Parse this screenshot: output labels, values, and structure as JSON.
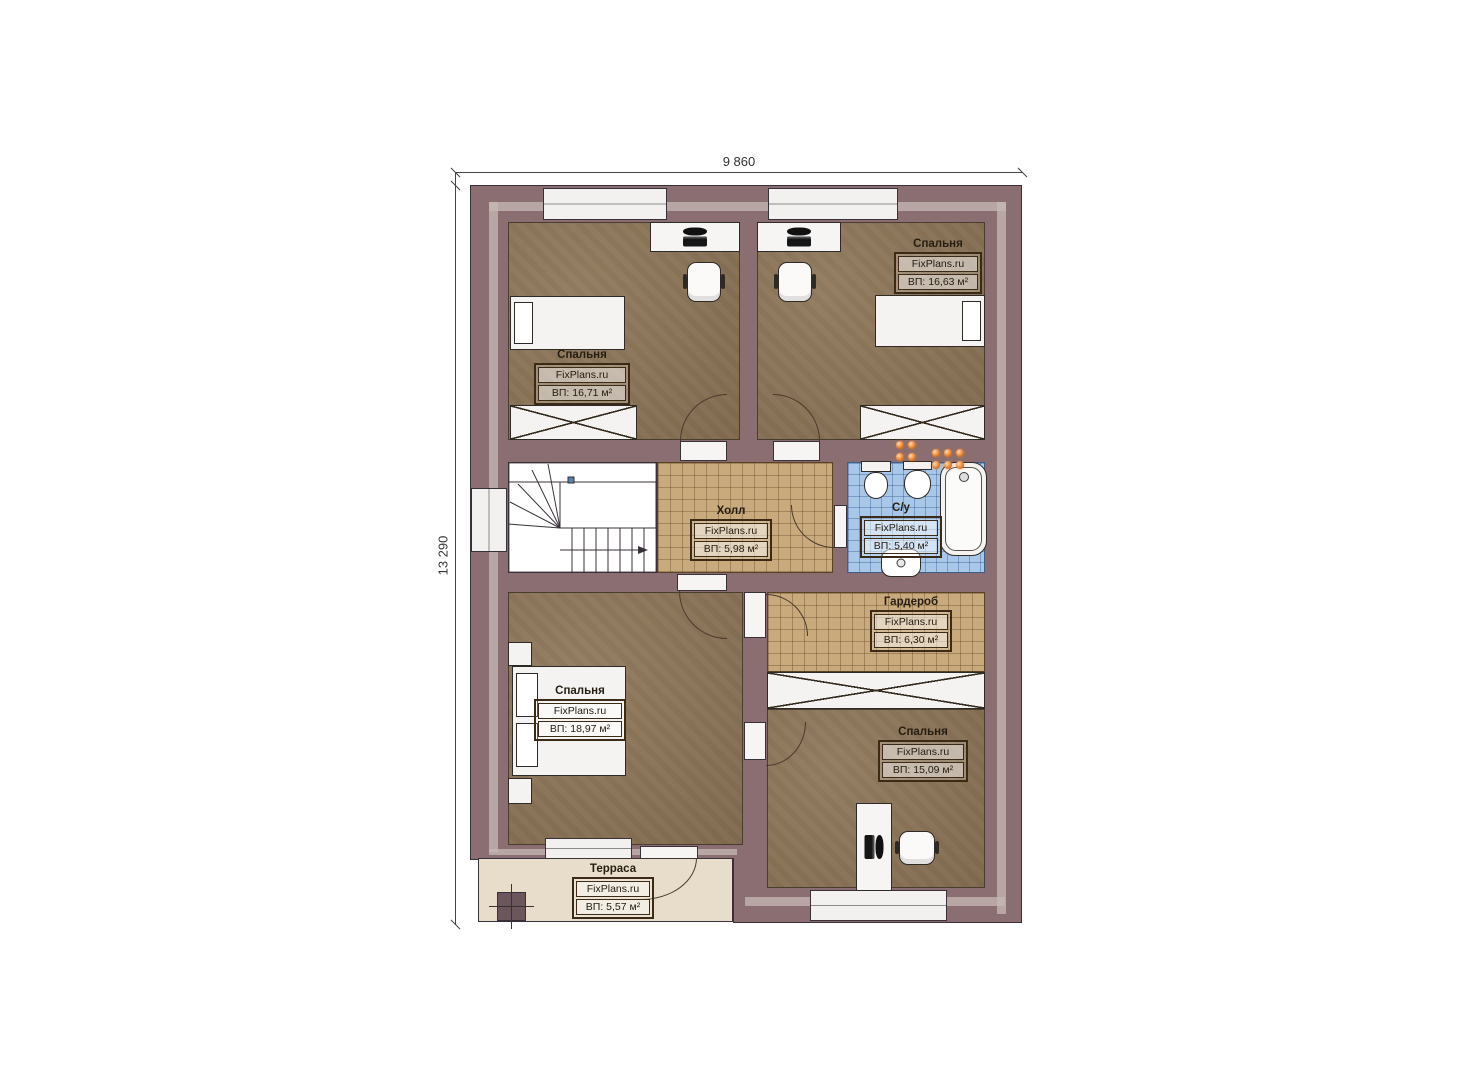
{
  "dimensions": {
    "width": "9 860",
    "height": "13 290"
  },
  "rooms": [
    {
      "name": "Спальня",
      "brand": "FixPlans.ru",
      "area": "ВП: 16,71 м²"
    },
    {
      "name": "Спальня",
      "brand": "FixPlans.ru",
      "area": "ВП: 16,63 м²"
    },
    {
      "name": "Холл",
      "brand": "FixPlans.ru",
      "area": "ВП: 5,98 м²"
    },
    {
      "name": "С/у",
      "brand": "FixPlans.ru",
      "area": "ВП: 5,40 м²"
    },
    {
      "name": "Гардероб",
      "brand": "FixPlans.ru",
      "area": "ВП: 6,30 м²"
    },
    {
      "name": "Спальня",
      "brand": "FixPlans.ru",
      "area": "ВП: 18,97 м²"
    },
    {
      "name": "Спальня",
      "brand": "FixPlans.ru",
      "area": "ВП: 15,09 м²"
    },
    {
      "name": "Терраса",
      "brand": "FixPlans.ru",
      "area": "ВП: 5,57 м²"
    }
  ],
  "colors": {
    "wall": "#8a6e72",
    "bedroom_floor": "#8b7355",
    "hall_tile": "#c9aa7d",
    "bath_tile": "#a9c8e9",
    "terrace_floor": "#e8ddca",
    "fixture_white": "#f2f1ef",
    "radiator_orange": "#d75f1e",
    "outline": "#39313a"
  }
}
